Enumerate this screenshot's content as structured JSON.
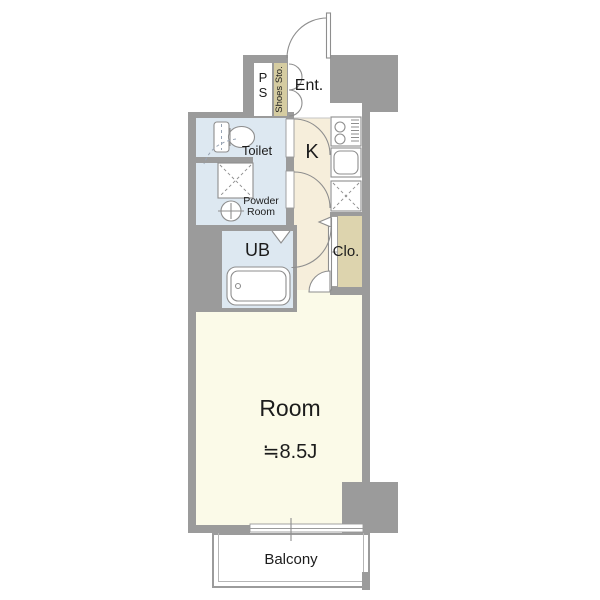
{
  "title": "One-room apartment floor plan",
  "colors": {
    "wall": "#9b9b9b",
    "wet": "#dde8f1",
    "room": "#fbfae8",
    "kitchen": "#f6eedb",
    "closet": "#ddd4ae",
    "shoes": "#d5cca1",
    "outline": "#8e8e8e",
    "text": "#1c1c1c",
    "floor-white": "#ffffff"
  },
  "rooms": {
    "pipe_space": {
      "label": "P\nS"
    },
    "shoes_storage": {
      "label": "Shoes Sto."
    },
    "entrance": {
      "label": "Ent."
    },
    "toilet": {
      "label": "Toilet"
    },
    "kitchen": {
      "label": "K"
    },
    "powder_room": {
      "label": "Powder\nRoom"
    },
    "unit_bath": {
      "label": "UB"
    },
    "closet": {
      "label": "Clo."
    },
    "main_room": {
      "label": "Room",
      "size": "≒8.5J"
    },
    "balcony": {
      "label": "Balcony"
    }
  }
}
